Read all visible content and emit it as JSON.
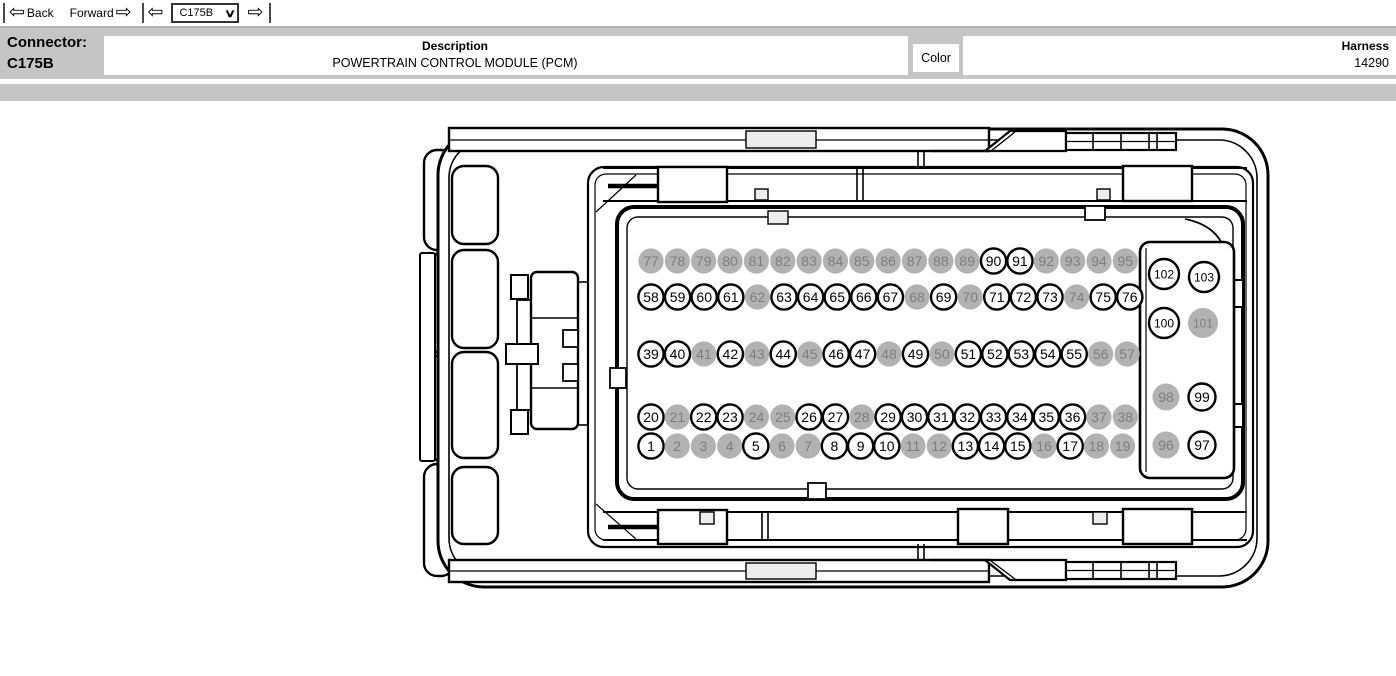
{
  "toolbar": {
    "back_label": "Back",
    "forward_label": "Forward",
    "connector_select": {
      "value": "C175B"
    },
    "icons": {
      "back": "⇦",
      "forward": "⇨",
      "prev": "⇦",
      "next": "⇨",
      "dropdown": "∨"
    }
  },
  "header": {
    "connector_label": "Connector:",
    "connector_id": "C175B",
    "description_label": "Description",
    "description_value": "POWERTRAIN CONTROL MODULE (PCM)",
    "color_label": "Color",
    "harness_label": "Harness",
    "harness_value": "14290"
  },
  "diagram": {
    "connector_name": "C175B",
    "colors": {
      "pin_fill": "#b2b2b2",
      "pin_text_gray": "#7d7d7d",
      "pin_outline": "#000000"
    },
    "rows": [
      {
        "start": 77,
        "end": 95,
        "x0": 651,
        "dx": 26.35,
        "y": 261,
        "r": 12.6
      },
      {
        "start": 58,
        "end": 76,
        "x0": 651,
        "dx": 26.6,
        "y": 297,
        "r": 12.6
      },
      {
        "start": 39,
        "end": 57,
        "x0": 651,
        "dx": 26.45,
        "y": 354,
        "r": 12.6
      },
      {
        "start": 20,
        "end": 38,
        "x0": 651,
        "dx": 26.35,
        "y": 417,
        "r": 12.6
      },
      {
        "start": 1,
        "end": 19,
        "x0": 651,
        "dx": 26.2,
        "y": 446,
        "r": 12.6
      }
    ],
    "aux_pins": [
      {
        "n": 102,
        "x": 1164,
        "y": 274,
        "r": 15
      },
      {
        "n": 103,
        "x": 1204,
        "y": 277,
        "r": 15
      },
      {
        "n": 100,
        "x": 1164,
        "y": 323,
        "r": 15
      },
      {
        "n": 101,
        "x": 1203,
        "y": 323,
        "r": 15
      },
      {
        "n": 98,
        "x": 1166,
        "y": 397,
        "r": 13.5
      },
      {
        "n": 99,
        "x": 1202,
        "y": 397,
        "r": 13.5
      },
      {
        "n": 96,
        "x": 1166,
        "y": 445,
        "r": 13.5
      },
      {
        "n": 97,
        "x": 1202,
        "y": 445,
        "r": 13.5
      }
    ],
    "gray_pins": [
      2,
      3,
      4,
      6,
      7,
      11,
      12,
      16,
      18,
      19,
      21,
      24,
      25,
      28,
      37,
      38,
      41,
      43,
      45,
      48,
      50,
      56,
      57,
      62,
      68,
      70,
      74,
      77,
      78,
      79,
      80,
      81,
      82,
      83,
      84,
      85,
      86,
      87,
      88,
      89,
      92,
      93,
      94,
      95,
      96,
      98,
      101
    ]
  }
}
